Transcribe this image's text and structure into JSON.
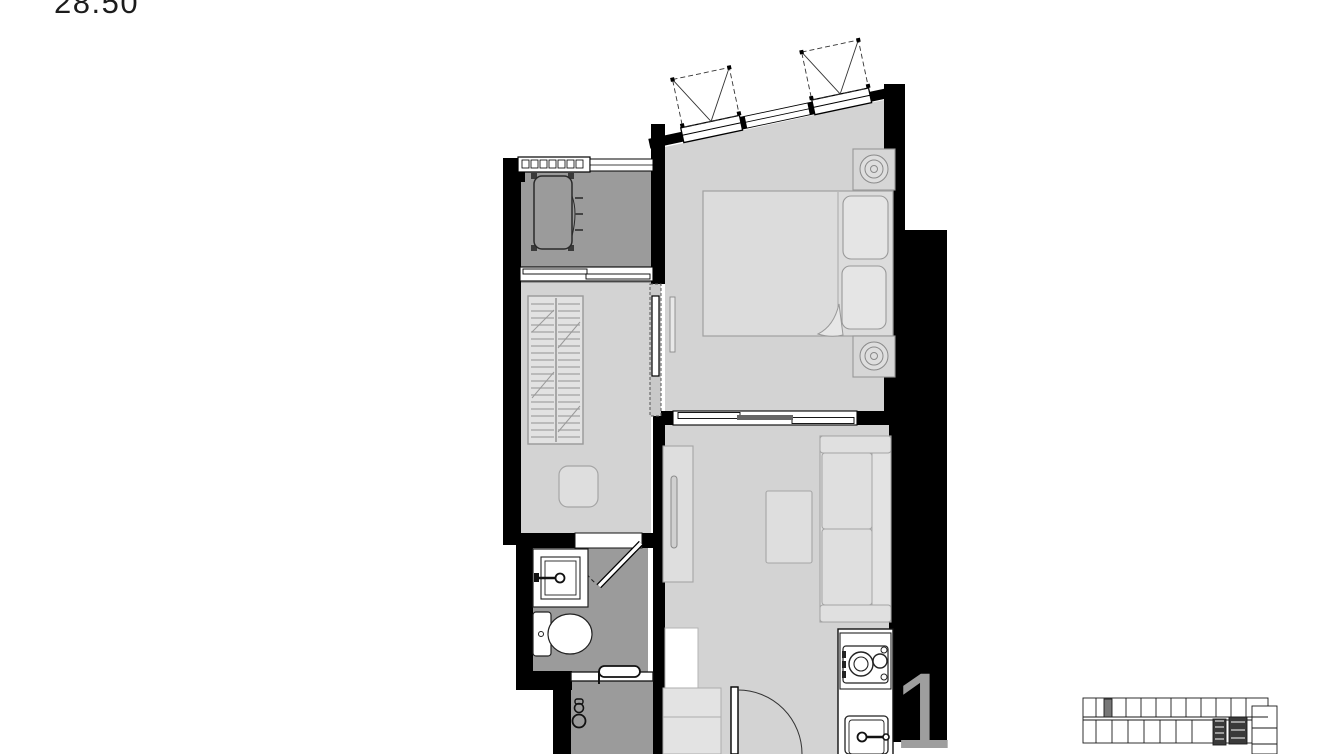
{
  "labels": {
    "area": "28.50",
    "unit_watermark": "1"
  },
  "colors": {
    "background": "#ffffff",
    "wall": "#000000",
    "floor_light": "#d3d3d3",
    "floor_dark": "#9b9b9b",
    "furniture_fill": "#dedede",
    "furniture_outline": "#a0a0a0",
    "fixture_outline": "#111111",
    "watermark": "#9e9e9e",
    "keyplan_line": "#1a1a1a"
  }
}
